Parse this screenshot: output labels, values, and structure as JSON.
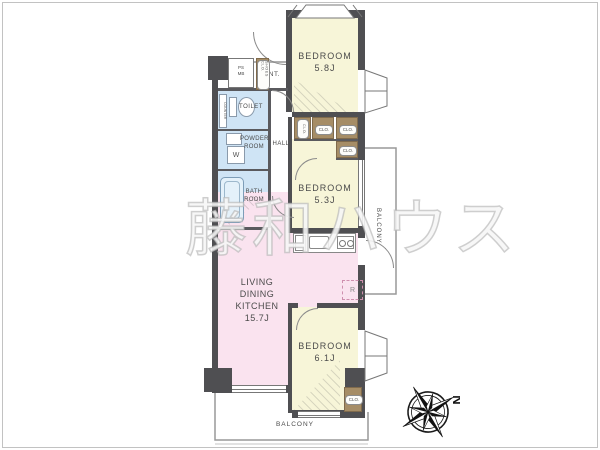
{
  "watermark": "藤和ハウス",
  "compass": {
    "north": "N"
  },
  "rooms": {
    "bedroom_top": {
      "name": "BEDROOM",
      "area": "5.8J"
    },
    "bedroom_mid": {
      "name": "BEDROOM",
      "area": "5.3J"
    },
    "bedroom_bottom": {
      "name": "BEDROOM",
      "area": "6.1J"
    },
    "ldk": {
      "line1": "LIVING",
      "line2": "DINING KITCHEN",
      "area": "15.7J"
    },
    "entrance": {
      "label": "ENT."
    },
    "hall": {
      "label": "HALL"
    },
    "toilet": {
      "label": "TOILET"
    },
    "powder_room": {
      "line1": "POWDER",
      "line2": "ROOM"
    },
    "bath_room": {
      "line1": "BATH",
      "line2": "ROOM"
    },
    "balcony_bottom": {
      "label": "BALCONY"
    },
    "balcony_right": {
      "label": "BALCONY"
    }
  },
  "labels": {
    "closet": "CLO.",
    "shoes_closet": "SHOES CLO.",
    "meter_box_line1": "PS",
    "meter_box_line2": "MB",
    "washing_machine": "W",
    "refrigerator": "R",
    "counter": "COUNTER"
  },
  "colors": {
    "wall": "#4f4f52",
    "bedroom_fill": "#f7f5d8",
    "ldk_fill": "#fae3ef",
    "wet_area_fill": "#cfe4f5",
    "closet_fill": "#a68d66",
    "balcony_line": "#999999"
  }
}
